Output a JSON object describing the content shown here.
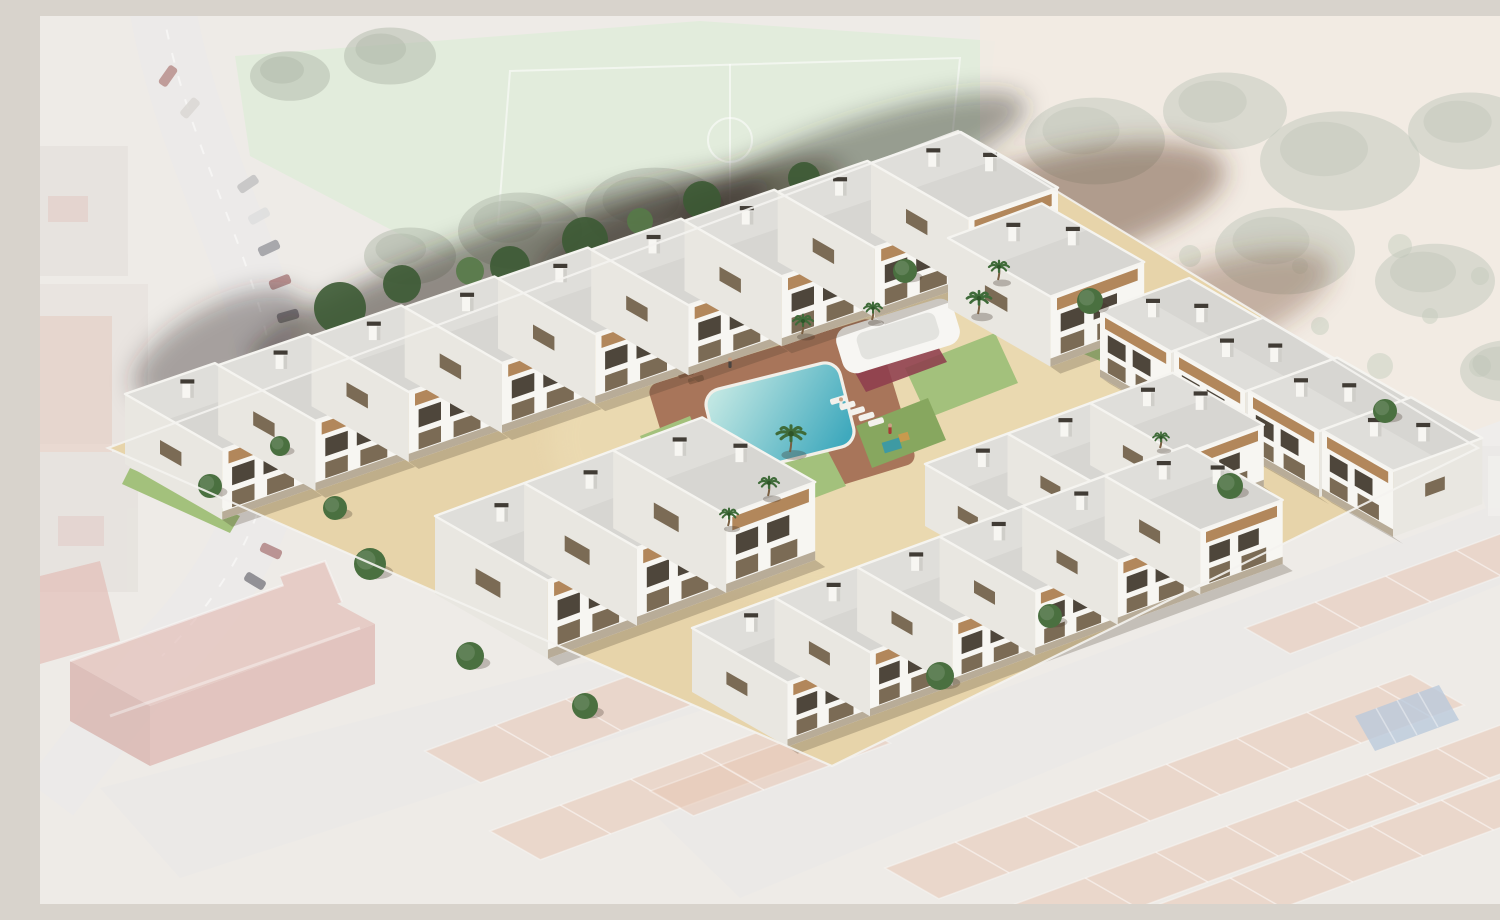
{
  "meta": {
    "title": "Aerial render of a new-build white townhouse complex with central pool, composited onto a faded aerial photo of the surrounding town",
    "image_type": "architectural-visualization",
    "view": "aerial-oblique"
  },
  "development": {
    "label": "new-build residential complex",
    "building_style": "white three-storey townhouses with flat grey roofs, chimneys and timber pergola balconies",
    "units_visible": 26,
    "rows": [
      {
        "name": "top-left-row",
        "units": 9
      },
      {
        "name": "top-right-block",
        "units": 1
      },
      {
        "name": "right-row",
        "units": 4
      },
      {
        "name": "mid-left-block",
        "units": 3
      },
      {
        "name": "bottom-inner-row",
        "units": 3
      },
      {
        "name": "bottom-outer-row",
        "units": 6
      }
    ],
    "amenities": [
      "swimming-pool",
      "timber-sun-deck",
      "sun-loungers",
      "palm-trees",
      "lawns",
      "white-canopy-lounge-pavilion",
      "playground",
      "perimeter-glass-fence"
    ],
    "people_visible": 3
  },
  "surroundings": {
    "treatment": "faded desaturated aerial photograph",
    "top_left": [
      "curved road",
      "parked cars",
      "pale green sports court",
      "tree canopy",
      "apartment blocks"
    ],
    "top_right": [
      "scrubland with bushes",
      "sandy soil"
    ],
    "bottom_left": [
      "red historic school building",
      "terracotta roofs",
      "streets"
    ],
    "bottom_right": [
      "rows of terracotta townhouses",
      "street",
      "rooftop solar panels"
    ]
  },
  "colors": {
    "wall-front": "#f7f6f2",
    "wall-side": "#e9e7e1",
    "roof": "#d7d6d2",
    "roof-light": "#e1e0dc",
    "parapet": "#f5f4f0",
    "window-dark": "#4e463b",
    "window-mid": "#7b6b55",
    "pergola": "#b2875b",
    "plinth": "#85704f",
    "pool-shallow": "#bfe6e2",
    "pool-deep": "#3fa9bd",
    "deck": "#a8755a",
    "paving": "#e7d4aa",
    "lawn": "#a3c17c",
    "lawn-dark": "#87a75f",
    "palm": "#3f6b39",
    "tree": "#4a7040",
    "tree-dark": "#3c5a34",
    "tree-faded": "#7e8b72",
    "sand": "#e4d6c4",
    "soil": "#8a5a40",
    "smoke": "#332a21",
    "court": "#cfdfc5",
    "road": "#e0ddda",
    "street": "#dedbd7",
    "terracotta": "#d8a282",
    "school-red": "#c4766c",
    "school-roof": "#cf8b80",
    "solar": "#8da6c4",
    "fence": "#f4f3f0",
    "canopy": "#f7f6f3",
    "lounge-red": "#8e3e4d"
  }
}
